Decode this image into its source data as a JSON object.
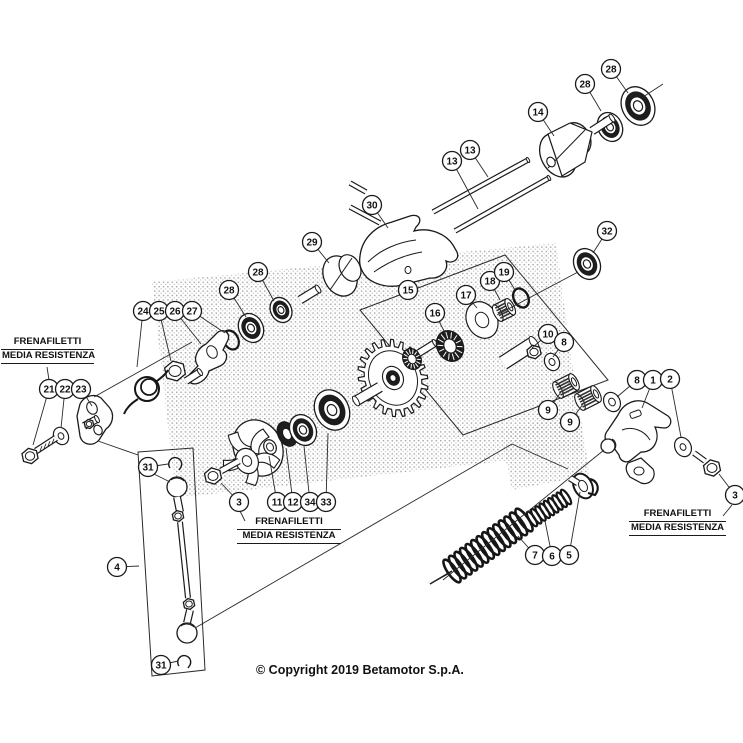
{
  "diagram": {
    "title_hidden": "",
    "copyright": "© Copyright 2019 Betamotor S.p.A.",
    "colors": {
      "line": "#1a1a1a",
      "dark_fill": "#1d1d1d",
      "background": "#ffffff"
    },
    "copyright_pos": {
      "x": 256,
      "y": 663
    },
    "thread_labels": [
      {
        "line1": "FRENAFILETTI",
        "line2": "MEDIA RESISTENZA",
        "x": 1,
        "y": 336,
        "w": 93
      },
      {
        "line1": "FRENAFILETTI",
        "line2": "MEDIA RESISTENZA",
        "x": 237,
        "y": 516,
        "w": 104
      },
      {
        "line1": "FRENAFILETTI",
        "line2": "MEDIA RESISTENZA",
        "x": 629,
        "y": 508,
        "w": 97
      }
    ],
    "callouts": [
      {
        "n": "28",
        "x": 611,
        "y": 69,
        "tx": 628,
        "ty": 93
      },
      {
        "n": "28",
        "x": 585,
        "y": 84,
        "tx": 601,
        "ty": 111
      },
      {
        "n": "14",
        "x": 538,
        "y": 112,
        "tx": 554,
        "ty": 136
      },
      {
        "n": "13",
        "x": 470,
        "y": 150,
        "tx": 488,
        "ty": 177
      },
      {
        "n": "13",
        "x": 452,
        "y": 161,
        "tx": 478,
        "ty": 209
      },
      {
        "n": "30",
        "x": 372,
        "y": 205,
        "tx": 388,
        "ty": 228
      },
      {
        "n": "32",
        "x": 607,
        "y": 231,
        "tx": 593,
        "ty": 253
      },
      {
        "n": "29",
        "x": 312,
        "y": 242,
        "tx": 329,
        "ty": 263
      },
      {
        "n": "28",
        "x": 258,
        "y": 272,
        "tx": 274,
        "ty": 301
      },
      {
        "n": "28",
        "x": 229,
        "y": 290,
        "tx": 246,
        "ty": 317
      },
      {
        "n": "15",
        "x": 408,
        "y": 290,
        "tx": 413,
        "ty": 297
      },
      {
        "n": "16",
        "x": 435,
        "y": 313,
        "tx": 446,
        "ty": 335
      },
      {
        "n": "17",
        "x": 466,
        "y": 295,
        "tx": 477,
        "ty": 308
      },
      {
        "n": "18",
        "x": 490,
        "y": 281,
        "tx": 500,
        "ty": 300
      },
      {
        "n": "19",
        "x": 504,
        "y": 272,
        "tx": 515,
        "ty": 290
      },
      {
        "n": "10",
        "x": 548,
        "y": 334,
        "tx": 532,
        "ty": 348
      },
      {
        "n": "8",
        "x": 564,
        "y": 342,
        "tx": 553,
        "ty": 357
      },
      {
        "n": "9",
        "x": 548,
        "y": 410,
        "tx": 561,
        "ty": 392
      },
      {
        "n": "9",
        "x": 570,
        "y": 422,
        "tx": 583,
        "ty": 404
      },
      {
        "n": "8",
        "x": 637,
        "y": 380,
        "tx": 617,
        "ty": 397
      },
      {
        "n": "1",
        "x": 653,
        "y": 380,
        "tx": 642,
        "ty": 408
      },
      {
        "n": "2",
        "x": 670,
        "y": 379,
        "tx": 681,
        "ty": 437
      },
      {
        "n": "3",
        "x": 735,
        "y": 495,
        "tx": 719,
        "ty": 474
      },
      {
        "n": "24",
        "x": 143,
        "y": 311,
        "tx": 137,
        "ty": 367
      },
      {
        "n": "25",
        "x": 159,
        "y": 311,
        "tx": 171,
        "ty": 361
      },
      {
        "n": "26",
        "x": 175,
        "y": 311,
        "tx": 201,
        "ty": 344
      },
      {
        "n": "27",
        "x": 192,
        "y": 311,
        "tx": 225,
        "ty": 333
      },
      {
        "n": "21",
        "x": 49,
        "y": 389,
        "tx": 33,
        "ty": 445
      },
      {
        "n": "22",
        "x": 65,
        "y": 389,
        "tx": 61,
        "ty": 428
      },
      {
        "n": "23",
        "x": 81,
        "y": 389,
        "tx": 92,
        "ty": 406
      },
      {
        "n": "31",
        "x": 148,
        "y": 467,
        "tx": 168,
        "ty": 464
      },
      {
        "n": "4",
        "x": 117,
        "y": 567,
        "tx": 139,
        "ty": 566
      },
      {
        "n": "31",
        "x": 161,
        "y": 665,
        "tx": 178,
        "ty": 661
      },
      {
        "n": "3",
        "x": 239,
        "y": 502,
        "tx": 221,
        "ty": 483
      },
      {
        "n": "11",
        "x": 277,
        "y": 502,
        "tx": 269,
        "ty": 456
      },
      {
        "n": "12",
        "x": 293,
        "y": 502,
        "tx": 286,
        "ty": 448
      },
      {
        "n": "34",
        "x": 310,
        "y": 502,
        "tx": 304,
        "ty": 446
      },
      {
        "n": "33",
        "x": 326,
        "y": 502,
        "tx": 328,
        "ty": 433
      },
      {
        "n": "7",
        "x": 535,
        "y": 555,
        "tx": 518,
        "ty": 536
      },
      {
        "n": "6",
        "x": 552,
        "y": 556,
        "tx": 545,
        "ty": 521
      },
      {
        "n": "5",
        "x": 569,
        "y": 555,
        "tx": 580,
        "ty": 492
      }
    ],
    "link_lines": [
      [
        98,
        441,
        138,
        455
      ],
      [
        195,
        628,
        512,
        444
      ],
      [
        512,
        444,
        568,
        469
      ],
      [
        443,
        580,
        604,
        450
      ],
      [
        430,
        584,
        450,
        573
      ],
      [
        643,
        97,
        663,
        84
      ],
      [
        578,
        272,
        497,
        315
      ],
      [
        94,
        397,
        192,
        342
      ],
      [
        47,
        367,
        49,
        380
      ],
      [
        245,
        521,
        240,
        511
      ],
      [
        723,
        516,
        732,
        505
      ],
      [
        154,
        474,
        170,
        482
      ]
    ],
    "boxes": [
      {
        "name": "box-gear-kit-15",
        "points": "360,310 505,255 608,380 463,435"
      },
      {
        "name": "box-rod-kit-4",
        "points": "138,452 193,448 205,670 152,676"
      }
    ]
  }
}
